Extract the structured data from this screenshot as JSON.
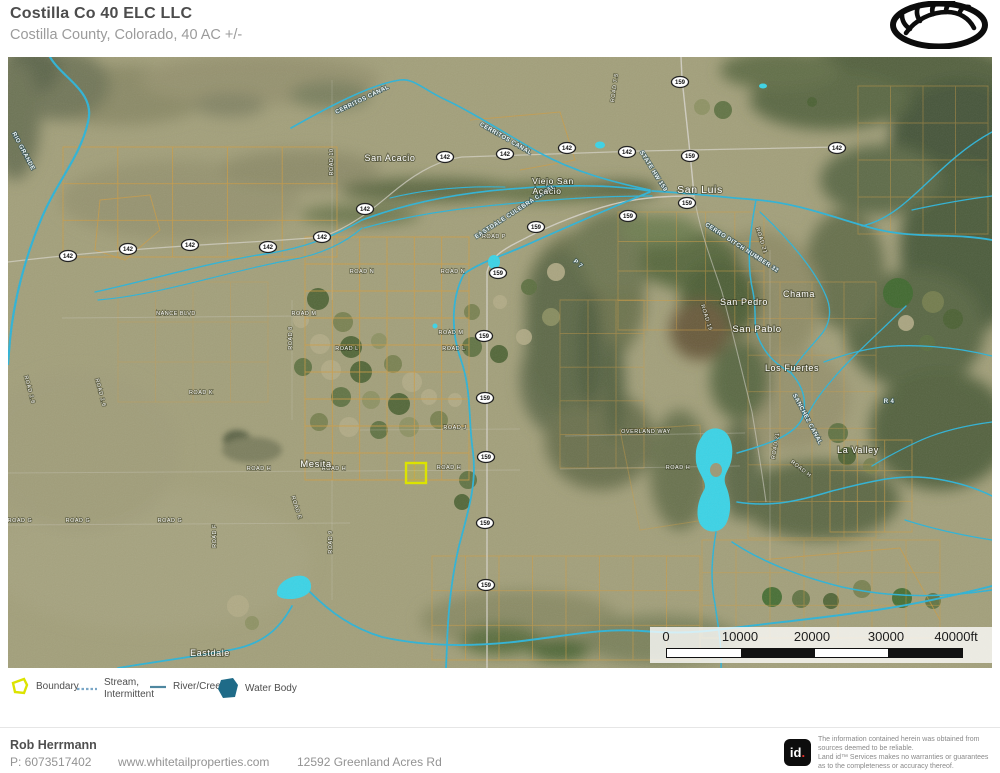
{
  "header": {
    "title": "Costilla Co 40 ELC LLC",
    "subtitle": "Costilla County, Colorado, 40 AC +/-"
  },
  "map": {
    "towns": [
      {
        "t": "San Acacio",
        "x": 390,
        "y": 161,
        "s": 9
      },
      {
        "t": "Viejo San",
        "x": 553,
        "y": 184,
        "s": 8.5
      },
      {
        "t": "Acacio",
        "x": 547,
        "y": 194,
        "s": 8.5
      },
      {
        "t": "San Luis",
        "x": 700,
        "y": 193,
        "s": 10.5
      },
      {
        "t": "San Pedro",
        "x": 744,
        "y": 305,
        "s": 9
      },
      {
        "t": "Chama",
        "x": 799,
        "y": 297,
        "s": 9
      },
      {
        "t": "San Pablo",
        "x": 757,
        "y": 332,
        "s": 9.5
      },
      {
        "t": "Los Fuertes",
        "x": 792,
        "y": 371,
        "s": 9
      },
      {
        "t": "La Valley",
        "x": 858,
        "y": 453,
        "s": 9
      },
      {
        "t": "Mesita",
        "x": 316,
        "y": 467,
        "s": 9.5
      },
      {
        "t": "Eastdale",
        "x": 210,
        "y": 656,
        "s": 9
      }
    ],
    "roads": [
      {
        "t": "NANCE BLVD",
        "x": 176,
        "y": 315
      },
      {
        "t": "ROAD M",
        "x": 304,
        "y": 315
      },
      {
        "t": "ROAD M",
        "x": 451,
        "y": 334
      },
      {
        "t": "ROAD N",
        "x": 362,
        "y": 273
      },
      {
        "t": "ROAD N",
        "x": 453,
        "y": 273
      },
      {
        "t": "ROAD L",
        "x": 347,
        "y": 350
      },
      {
        "t": "ROAD L",
        "x": 454,
        "y": 350
      },
      {
        "t": "ROAD K",
        "x": 201,
        "y": 394
      },
      {
        "t": "ROAD J",
        "x": 455,
        "y": 429
      },
      {
        "t": "ROAD H",
        "x": 259,
        "y": 470
      },
      {
        "t": "ROAD H",
        "x": 334,
        "y": 470
      },
      {
        "t": "ROAD H",
        "x": 449,
        "y": 469
      },
      {
        "t": "ROAD H",
        "x": 678,
        "y": 469
      },
      {
        "t": "ROAD H",
        "x": 800,
        "y": 470,
        "r": 38
      },
      {
        "t": "ROAD G",
        "x": 20,
        "y": 522
      },
      {
        "t": "ROAD G",
        "x": 78,
        "y": 522
      },
      {
        "t": "ROAD G",
        "x": 170,
        "y": 522
      },
      {
        "t": "ROAD F",
        "x": 216,
        "y": 536,
        "r": -90
      },
      {
        "t": "ROAD E",
        "x": 295,
        "y": 508,
        "r": 72
      },
      {
        "t": "ROAD 9",
        "x": 332,
        "y": 542,
        "r": -90
      },
      {
        "t": "ROAD 10",
        "x": 333,
        "y": 162,
        "r": -90
      },
      {
        "t": "ROAD 8",
        "x": 292,
        "y": 338,
        "r": -90
      },
      {
        "t": "ROAD 2.8",
        "x": 28,
        "y": 390,
        "r": 75
      },
      {
        "t": "ROAD 2.6",
        "x": 99,
        "y": 393,
        "r": 75
      },
      {
        "t": "ROAD P",
        "x": 494,
        "y": 238
      },
      {
        "t": "ROAD 7.5",
        "x": 616,
        "y": 88,
        "r": -82
      },
      {
        "t": "OVERLAND WAY",
        "x": 646,
        "y": 433
      },
      {
        "t": "ROAD 21",
        "x": 760,
        "y": 241,
        "r": 72
      },
      {
        "t": "ROAD 21",
        "x": 777,
        "y": 446,
        "r": -80
      },
      {
        "t": "ROAD 19",
        "x": 705,
        "y": 318,
        "r": 72
      }
    ],
    "waterways": [
      {
        "t": "RIO GRANDE",
        "x": 22,
        "y": 152,
        "r": 62
      },
      {
        "t": "CERRITOS CANAL",
        "x": 363,
        "y": 101,
        "r": -26
      },
      {
        "t": "CERRITOS CANAL",
        "x": 505,
        "y": 140,
        "r": 30
      },
      {
        "t": "EASTDALE CULEBRA CANAL",
        "x": 516,
        "y": 213,
        "r": -33
      },
      {
        "t": "STATE HW 159",
        "x": 652,
        "y": 172,
        "r": 58
      },
      {
        "t": "CERRO DITCH NUMBER 32",
        "x": 741,
        "y": 249,
        "r": 33
      },
      {
        "t": "SANCHEZ CANAL",
        "x": 806,
        "y": 420,
        "r": 62
      },
      {
        "t": "P 7",
        "x": 577,
        "y": 265,
        "r": 40
      },
      {
        "t": "R 4",
        "x": 889,
        "y": 403,
        "r": 0
      }
    ],
    "shields": [
      {
        "n": "142",
        "x": 68,
        "y": 256
      },
      {
        "n": "142",
        "x": 128,
        "y": 249
      },
      {
        "n": "142",
        "x": 190,
        "y": 245
      },
      {
        "n": "142",
        "x": 268,
        "y": 247
      },
      {
        "n": "142",
        "x": 322,
        "y": 237
      },
      {
        "n": "142",
        "x": 365,
        "y": 209
      },
      {
        "n": "142",
        "x": 445,
        "y": 157
      },
      {
        "n": "142",
        "x": 505,
        "y": 154
      },
      {
        "n": "142",
        "x": 567,
        "y": 148
      },
      {
        "n": "142",
        "x": 627,
        "y": 152
      },
      {
        "n": "142",
        "x": 837,
        "y": 148
      },
      {
        "n": "159",
        "x": 680,
        "y": 82
      },
      {
        "n": "159",
        "x": 690,
        "y": 156
      },
      {
        "n": "159",
        "x": 687,
        "y": 203
      },
      {
        "n": "159",
        "x": 628,
        "y": 216
      },
      {
        "n": "159",
        "x": 536,
        "y": 227
      },
      {
        "n": "159",
        "x": 498,
        "y": 273
      },
      {
        "n": "159",
        "x": 484,
        "y": 336
      },
      {
        "n": "159",
        "x": 485,
        "y": 398
      },
      {
        "n": "159",
        "x": 486,
        "y": 457
      },
      {
        "n": "159",
        "x": 485,
        "y": 523
      },
      {
        "n": "159",
        "x": 486,
        "y": 585
      }
    ],
    "boundary_box": {
      "x": 406,
      "y": 463,
      "w": 20,
      "h": 20
    },
    "scalebar": {
      "labels": [
        "0",
        "10000",
        "20000",
        "30000",
        "40000ft"
      ]
    }
  },
  "legend": {
    "boundary": "Boundary",
    "stream_line1": "Stream,",
    "stream_line2": "Intermittent",
    "river": "River/Creek",
    "water": "Water Body"
  },
  "footer": {
    "agent": "Rob Herrmann",
    "phone": "P: 6073517402",
    "website": "www.whitetailproperties.com",
    "address": "12592 Greenland Acres Rd"
  },
  "attribution": {
    "logo_text": "id",
    "logo_dot": ".",
    "lines": [
      "The information contained herein was obtained from",
      "sources deemed to be reliable.",
      "Land id™ Services makes no warranties or guarantees",
      "as to the completeness or accuracy thereof."
    ]
  },
  "colors": {
    "boundary": "#dce300",
    "stream": "#7aa7c7",
    "river": "#4e87a0",
    "water_body_legend": "#1f6b88",
    "water_bright": "#3bd3e6",
    "river_map": "#2eb3d6",
    "parcel": "#cf9c42"
  }
}
